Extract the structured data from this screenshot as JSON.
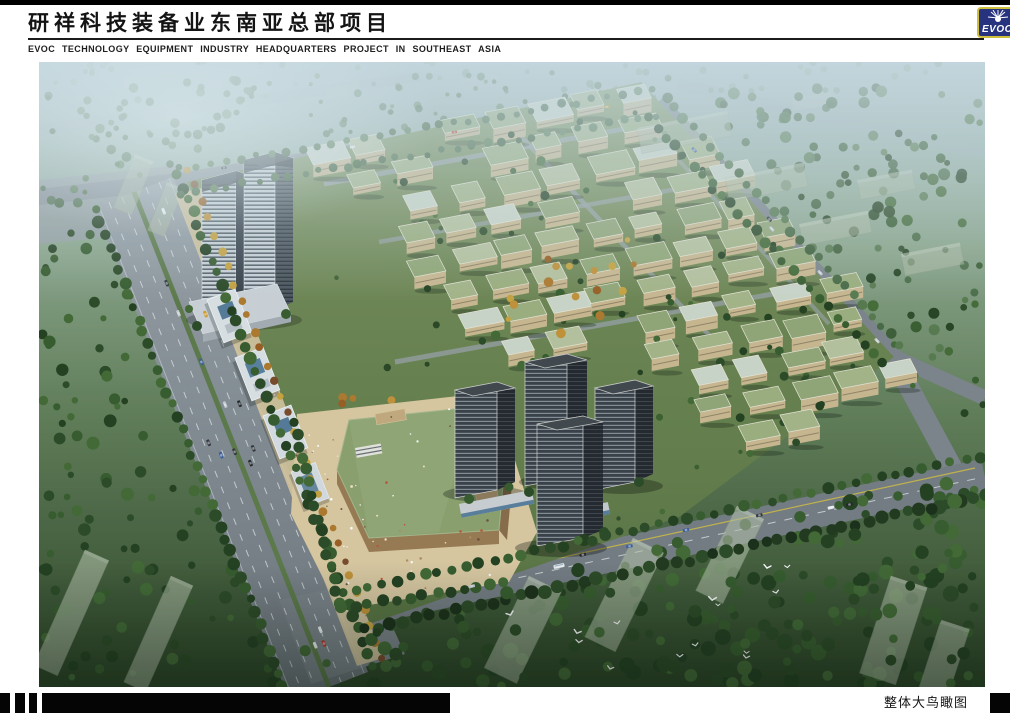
{
  "page": {
    "width": 1010,
    "height": 714,
    "background": "#ffffff"
  },
  "header": {
    "top_bar_color": "#000000",
    "title_zh": "研祥科技装备业东南亚总部项目",
    "title_en": "EVOC TECHNOLOGY EQUIPMENT INDUSTRY HEADQUARTERS PROJECT IN SOUTHEAST ASIA"
  },
  "logo": {
    "text": "EVOC",
    "background": "#27337e",
    "border": "#cfc03c",
    "icon": "starburst-sun-icon"
  },
  "rendering": {
    "palette": {
      "sky_haze": "#b9ccd2",
      "foliage_dark": "#2c4a25",
      "foliage_light": "#6b8a5e",
      "road_gray": "#82898f",
      "site_roof_green": "#9eb07f",
      "facade_tan": "#ccba91",
      "tower_glass_dark": "#4e575f",
      "residential_dark": "#3b4046",
      "plaza_sand": "#dccaa2"
    }
  },
  "footer": {
    "caption": "整体大鸟瞰图",
    "bar_color": "#000000"
  }
}
